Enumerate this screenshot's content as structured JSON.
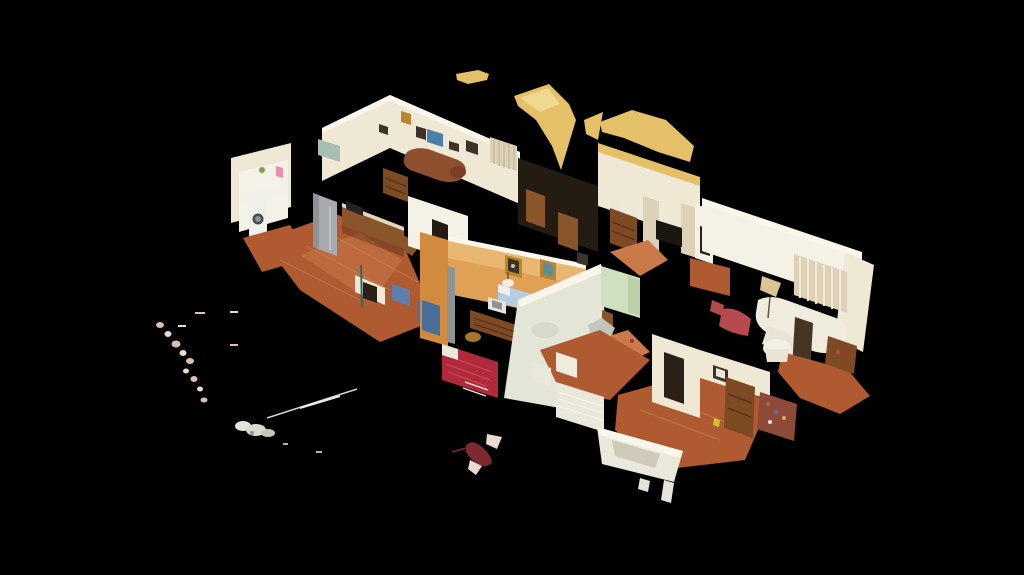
{
  "viewer": {
    "kind": "3d-dollhouse-scan-view",
    "rooms": [
      "laundry",
      "kitchen",
      "back-living-room",
      "hallway",
      "orange-bedroom",
      "dresser-room",
      "right-living-room",
      "green-hall",
      "lace-bed-room",
      "bottom-right-room",
      "bottom-bedroom"
    ]
  },
  "colors": {
    "background": "#000000",
    "wall_cream": "#efe8d5",
    "wall_white": "#f4f1e6",
    "wall_highlight": "#faf6ec",
    "wall_yellow": "#e4c169",
    "wall_yellow_light": "#f0d98e",
    "wall_orange": "#e0a055",
    "wall_orange_light": "#eec07f",
    "wall_orange_dark": "#d28a3e",
    "wall_mint": "#cfe0c0",
    "wall_mint_dark": "#b9d0a8",
    "wall_sage": "#e3e6d7",
    "hall_dark": "#241b12",
    "doorway_dark": "#2a2018",
    "floor_terracotta": "#b05a32",
    "floor_terracotta_light": "#c97a48",
    "wood": "#7e4a24",
    "wood_light": "#8a552a",
    "wood_dark": "#5a3415",
    "steel": "#a7abae",
    "steel_dark": "#8e9296",
    "sofa_brown": "#8e4f2e",
    "sofa_brown_dark": "#7a3f24",
    "sofa_white": "#efebdd",
    "sofa_white_dim": "#e9e4d4",
    "bed_red": "#b02a3c",
    "cushion_red": "#b64a4e",
    "bed_white": "#eae7db",
    "bed_white_shadow": "#cfc9b8",
    "bed_blue": "#b5cde0",
    "curtain": "#ddd2b6",
    "window_dark": "#1a1612",
    "window_glass": "#a9bdb4",
    "picture_blue": "#4d80a8",
    "picture_dark": "#3c3226",
    "frame_gold": "#b8862e",
    "teal_art": "#5e8e94",
    "lamp_shade": "#d9c694",
    "table_white": "#f1eee3",
    "shelf_red": "#8e4a38",
    "brass": "#a87828",
    "pole_grey": "#8e9494",
    "blue_item": "#4a6e9a",
    "blue_item2": "#5b7fae",
    "pink_towel": "#e88fb0",
    "plant_green": "#7aa050",
    "white_goods": "#f2f0ea",
    "counter_light": "#e4d6ba",
    "panel_dark": "#463522",
    "artifact_pink": "#dcc0ae",
    "artifact_cream": "#e9dccc",
    "artifact_white": "#e6e3da",
    "artifact_red": "#7e2830",
    "artifact_wing": "#ecd9d2",
    "yellow_tag": "#d8c030"
  }
}
